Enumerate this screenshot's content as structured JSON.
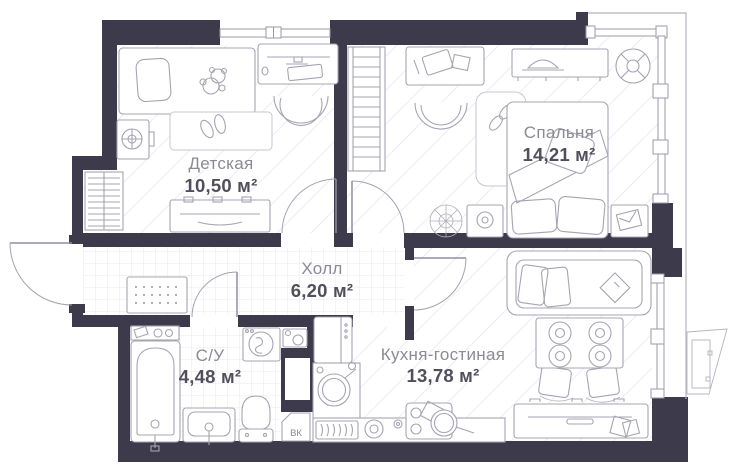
{
  "plan": {
    "rooms": [
      {
        "id": "children",
        "name": "Детская",
        "area": "10,50 м²"
      },
      {
        "id": "bedroom",
        "name": "Спальня",
        "area": "14,21 м²"
      },
      {
        "id": "hall",
        "name": "Холл",
        "area": "6,20 м²"
      },
      {
        "id": "bath",
        "name": "С/У",
        "area": "4,48 м²"
      },
      {
        "id": "kitchen",
        "name": "Кухня-гостиная",
        "area": "13,78 м²"
      }
    ],
    "shaft_label": "ВК",
    "colors": {
      "wall": "#3c3a4b",
      "furniture_line": "#a5a4b2",
      "room_name_text": "#8b8a95",
      "room_area_text": "#514f5c",
      "floor_grid_line": "#e9e9f1"
    }
  }
}
